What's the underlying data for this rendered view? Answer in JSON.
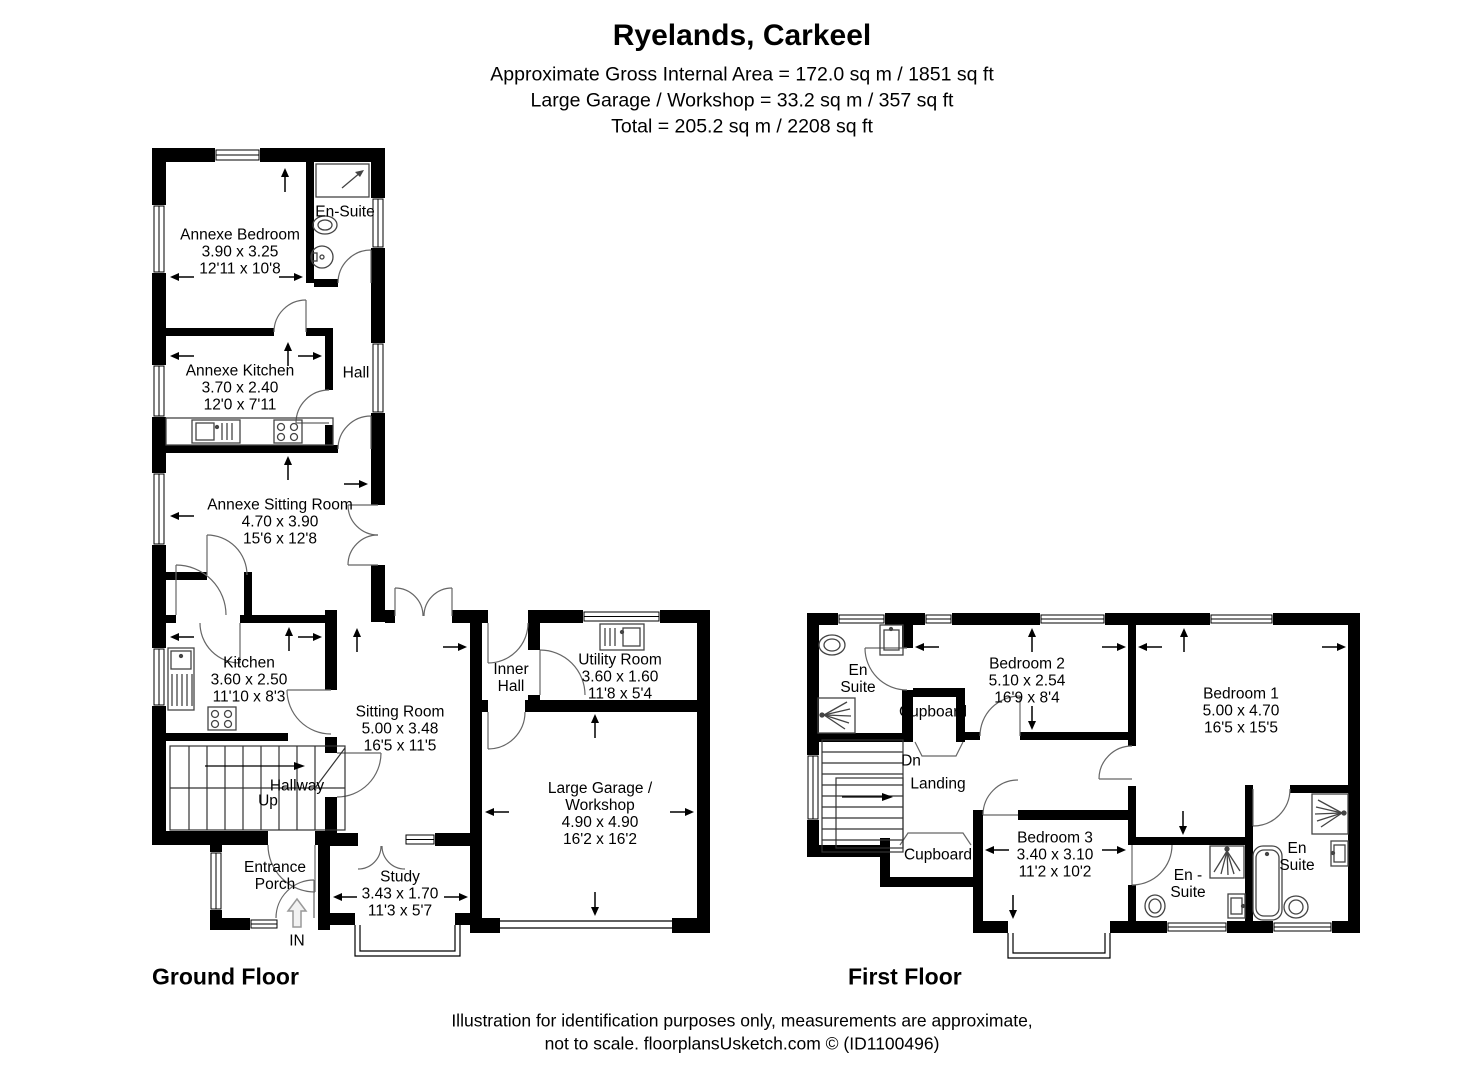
{
  "header": {
    "title": "Ryelands, Carkeel",
    "area_line_1": "Approximate Gross Internal Area = 172.0 sq m / 1851 sq ft",
    "area_line_2": "Large Garage / Workshop = 33.2 sq m / 357 sq ft",
    "area_line_3": "Total = 205.2 sq m / 2208 sq ft"
  },
  "ground_floor": {
    "label": "Ground Floor",
    "rooms": {
      "annexe_bedroom": {
        "lines": [
          "Annexe Bedroom",
          "3.90 x 3.25",
          "12'11 x 10'8"
        ]
      },
      "en_suite": {
        "lines": [
          "En-Suite"
        ]
      },
      "annexe_kitchen": {
        "lines": [
          "Annexe Kitchen",
          "3.70 x 2.40",
          "12'0 x 7'11"
        ]
      },
      "hall": {
        "lines": [
          "Hall"
        ]
      },
      "annexe_sitting_room": {
        "lines": [
          "Annexe Sitting Room",
          "4.70 x 3.90",
          "15'6 x 12'8"
        ]
      },
      "kitchen": {
        "lines": [
          "Kitchen",
          "3.60 x 2.50",
          "11'10 x 8'3"
        ]
      },
      "inner_hall": {
        "lines": [
          "Inner",
          "Hall"
        ]
      },
      "utility_room": {
        "lines": [
          "Utility Room",
          "3.60 x 1.60",
          "11'8 x 5'4"
        ]
      },
      "sitting_room": {
        "lines": [
          "Sitting Room",
          "5.00 x 3.48",
          "16'5 x 11'5"
        ]
      },
      "hallway": {
        "lines": [
          "Hallway"
        ]
      },
      "up": {
        "lines": [
          "Up"
        ]
      },
      "garage": {
        "lines": [
          "Large Garage /",
          "Workshop",
          "4.90 x 4.90",
          "16'2 x 16'2"
        ]
      },
      "entrance_porch": {
        "lines": [
          "Entrance",
          "Porch"
        ]
      },
      "study": {
        "lines": [
          "Study",
          "3.43 x 1.70",
          "11'3 x 5'7"
        ]
      },
      "entry": {
        "lines": [
          "IN"
        ]
      }
    }
  },
  "first_floor": {
    "label": "First Floor",
    "rooms": {
      "en_suite_1": {
        "lines": [
          "En",
          "Suite"
        ]
      },
      "cupboard_top": {
        "lines": [
          "Cupboard"
        ]
      },
      "bedroom_2": {
        "lines": [
          "Bedroom 2",
          "5.10 x 2.54",
          "16'9 x 8'4"
        ]
      },
      "bedroom_1": {
        "lines": [
          "Bedroom 1",
          "5.00 x 4.70",
          "16'5 x 15'5"
        ]
      },
      "dn": {
        "lines": [
          "Dn"
        ]
      },
      "landing": {
        "lines": [
          "Landing"
        ]
      },
      "cupboard_bottom": {
        "lines": [
          "Cupboard"
        ]
      },
      "bedroom_3": {
        "lines": [
          "Bedroom 3",
          "3.40 x 3.10",
          "11'2 x 10'2"
        ]
      },
      "en_suite_2": {
        "lines": [
          "En -",
          "Suite"
        ]
      },
      "en_suite_3": {
        "lines": [
          "En",
          "Suite"
        ]
      }
    }
  },
  "footer": {
    "line1": "Illustration for identification purposes only, measurements are approximate,",
    "line2": "not to scale. floorplansUsketch.com © (ID1100496)"
  }
}
